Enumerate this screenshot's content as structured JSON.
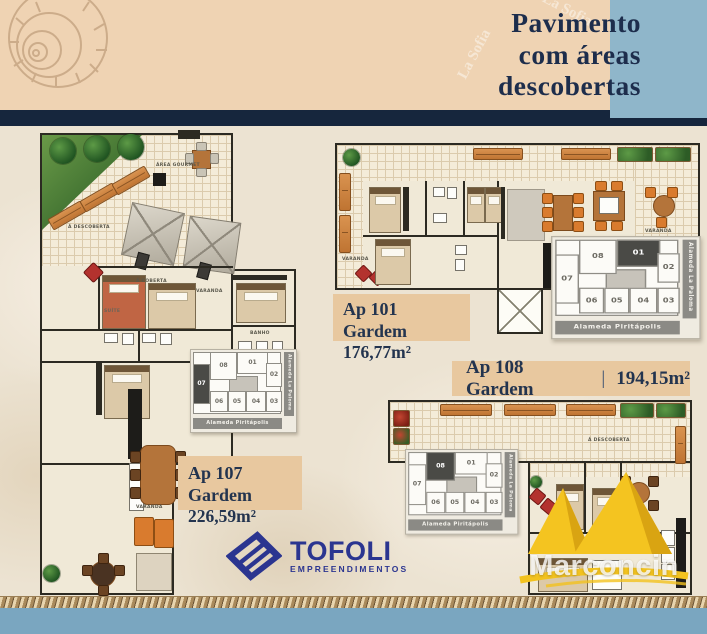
{
  "header": {
    "title_line1": "Pavimento",
    "title_line2": "com áreas",
    "title_line3": "descobertas",
    "watermark": "La Sofia",
    "colors": {
      "beige": "#efd3b3",
      "blue": "#8fb6ca",
      "navy": "#16263d",
      "title_text": "#1d2d4c"
    }
  },
  "plans": {
    "ap107": {
      "name": "Ap 107 Gardem",
      "area": "226,59m²",
      "highlight_unit": "07",
      "rooms": {
        "descoberta": "Á DESCOBERTA",
        "gourmet": "ÁREA GOURMET",
        "coberta": "Á COBERTA",
        "varanda_top": "VARANDA",
        "varanda_bottom": "VARANDA",
        "suite": "SUÍTE",
        "banho": "BANHO"
      }
    },
    "ap101": {
      "name": "Ap 101 Gardem",
      "area": "176,77m²",
      "highlight_unit": "01",
      "rooms": {
        "varanda_left": "VARANDA",
        "varanda_right": "VARANDA"
      }
    },
    "ap108": {
      "name": "Ap 108 Gardem",
      "separator": "|",
      "area": "194,15m²",
      "highlight_unit": "08",
      "rooms": {
        "descoberta": "Á DESCOBERTA"
      }
    }
  },
  "keyplan": {
    "street_bottom": "Alameda Piritápolis",
    "street_right": "Alameda La Paloma",
    "units": [
      "01",
      "02",
      "03",
      "04",
      "05",
      "06",
      "07",
      "08"
    ]
  },
  "logos": {
    "tofoli": {
      "name": "TOFOLI",
      "subtitle": "EMPREENDIMENTOS",
      "color": "#2b3590"
    },
    "marconcin": {
      "name": "Marconcin",
      "color": "#f2c21e"
    }
  }
}
